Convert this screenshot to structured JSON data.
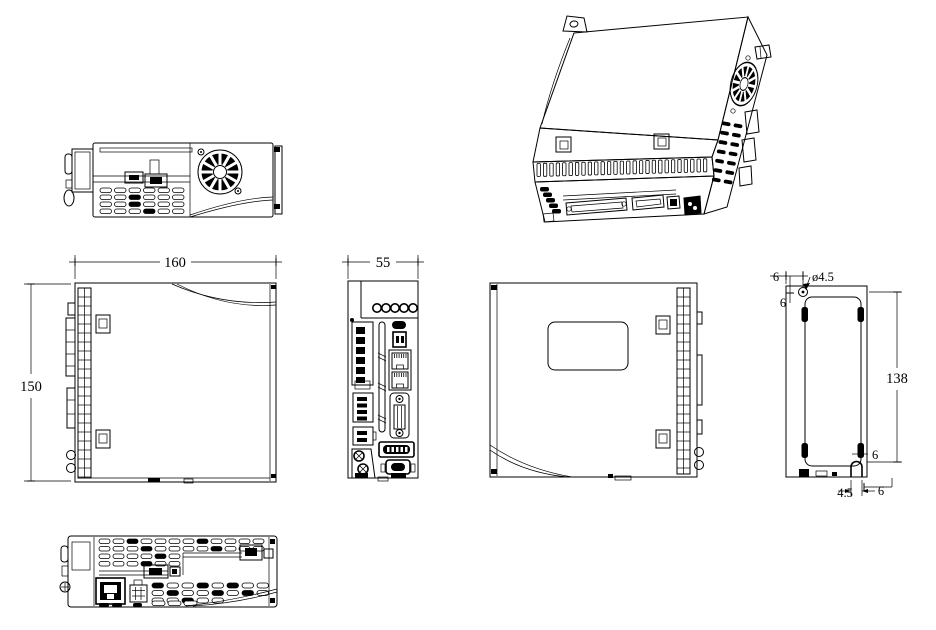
{
  "drawing": {
    "background_color": "#ffffff",
    "line_color": "#000000",
    "views": {
      "side_left": {
        "width": "160",
        "height": "150"
      },
      "front": {
        "width": "55"
      },
      "rear": {
        "hole_offset_x": "6",
        "hole_diameter": "ø4.5",
        "hole_offset_y": "6",
        "mounting_height": "138",
        "slot_offset": "6",
        "slot_width": "4.5",
        "edge_offset": "6"
      }
    }
  }
}
